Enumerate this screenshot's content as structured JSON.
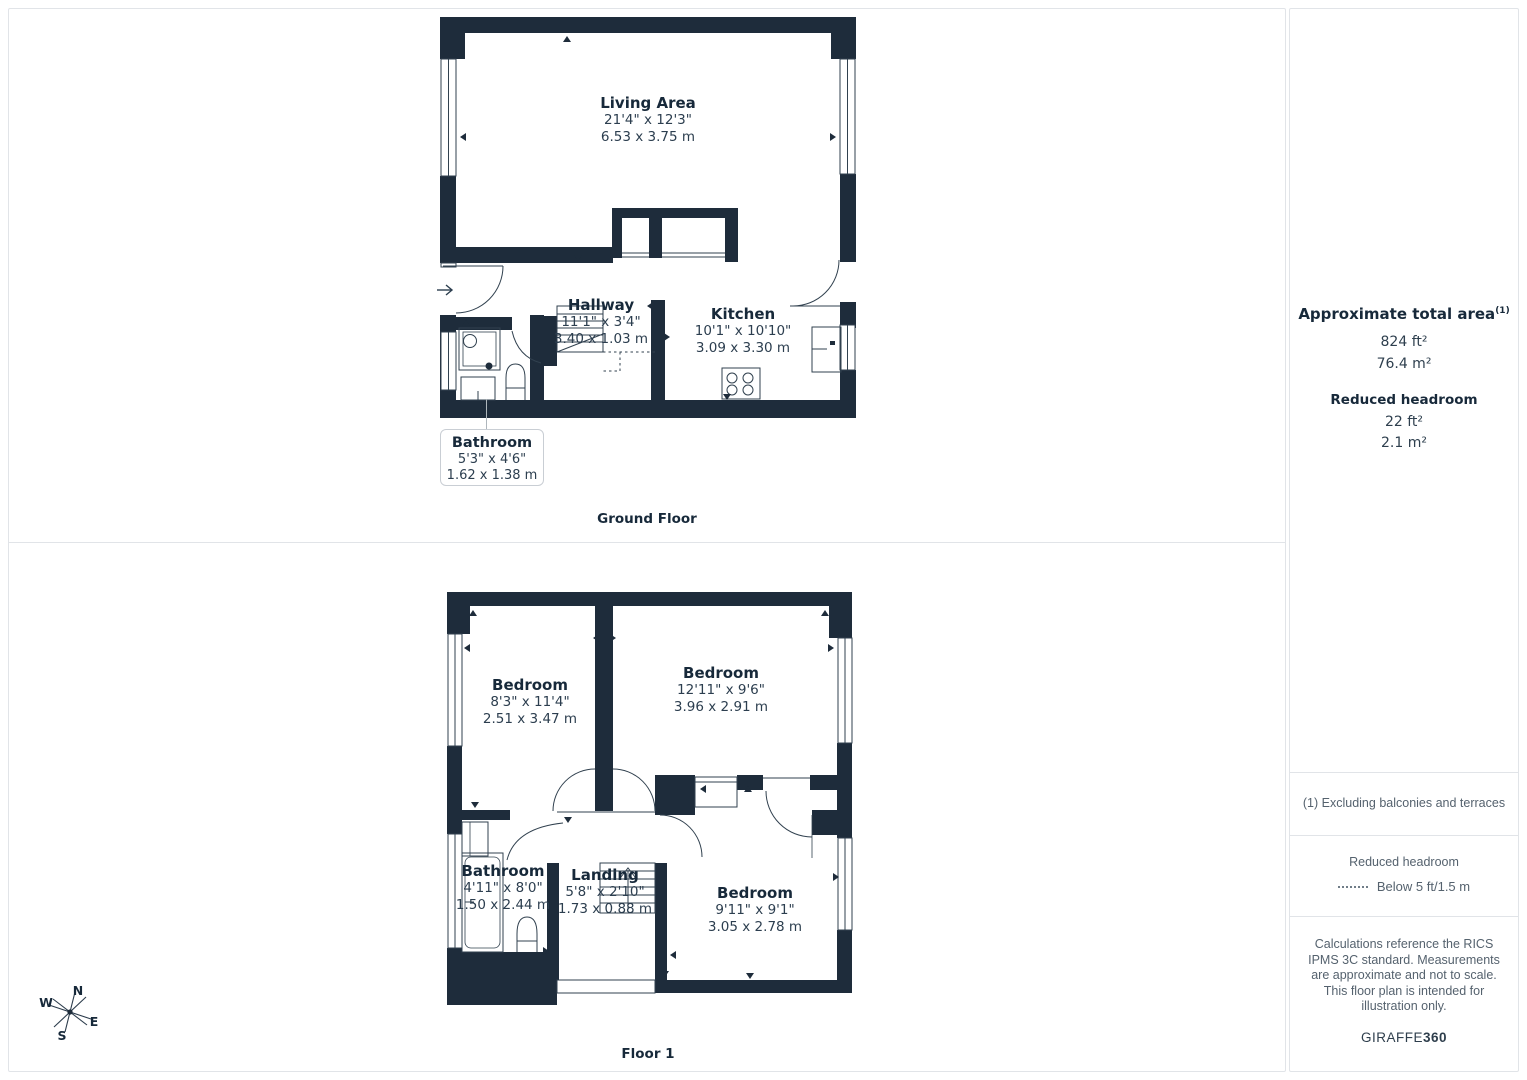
{
  "ground_floor": {
    "title": "Ground Floor",
    "rooms": [
      {
        "name": "Living Area",
        "imperial": "21'4\" x 12'3\"",
        "metric": "6.53 x 3.75 m"
      },
      {
        "name": "Hallway",
        "imperial": "11'1\" x 3'4\"",
        "metric": "3.40 x 1.03 m"
      },
      {
        "name": "Kitchen",
        "imperial": "10'1\" x 10'10\"",
        "metric": "3.09 x 3.30 m"
      },
      {
        "name": "Bathroom",
        "imperial": "5'3\" x 4'6\"",
        "metric": "1.62 x 1.38 m"
      }
    ]
  },
  "floor_1": {
    "title": "Floor 1",
    "rooms": [
      {
        "name": "Bedroom",
        "imperial": "8'3\" x 11'4\"",
        "metric": "2.51 x 3.47 m"
      },
      {
        "name": "Bedroom",
        "imperial": "12'11\" x 9'6\"",
        "metric": "3.96 x 2.91 m"
      },
      {
        "name": "Bathroom",
        "imperial": "4'11\" x 8'0\"",
        "metric": "1.50 x 2.44 m"
      },
      {
        "name": "Landing",
        "imperial": "5'8\" x 2'10\"",
        "metric": "1.73 x 0.88 m"
      },
      {
        "name": "Bedroom",
        "imperial": "9'11\" x 9'1\"",
        "metric": "3.05 x 2.78 m"
      }
    ]
  },
  "sidebar": {
    "total_area": {
      "title": "Approximate total area",
      "footnote_marker": "(1)",
      "imperial": "824 ft²",
      "metric": "76.4 m²"
    },
    "reduced_headroom_summary": {
      "title": "Reduced headroom",
      "imperial": "22 ft²",
      "metric": "2.1 m²"
    },
    "footnote": "(1) Excluding balconies and terraces",
    "legend": {
      "title": "Reduced headroom",
      "label": "Below 5 ft/1.5 m"
    },
    "disclaimer": "Calculations reference the RICS IPMS 3C standard. Measurements are approximate and not to scale. This floor plan is intended for illustration only.",
    "brand": {
      "name": "GIRAFFE",
      "suffix": "360"
    }
  },
  "compass": {
    "n": "N",
    "e": "E",
    "s": "S",
    "w": "W"
  },
  "colors": {
    "wall": "#1e2c3b",
    "text": "#17293a",
    "muted": "#55626e",
    "border": "#e1e4e8"
  }
}
